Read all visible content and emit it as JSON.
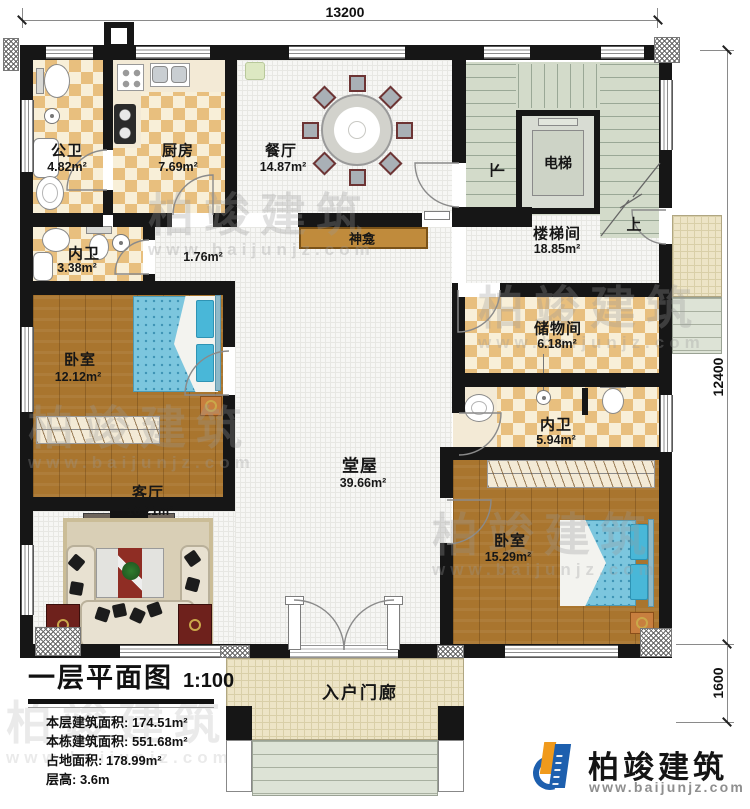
{
  "plan": {
    "dim_top": "13200",
    "dim_right": "12400",
    "dim_porch": "1600",
    "stair_down": "下",
    "stair_up": "上"
  },
  "rooms": {
    "public_bath": {
      "name": "公卫",
      "area": "4.82m²"
    },
    "kitchen": {
      "name": "厨房",
      "area": "7.69m²"
    },
    "dining": {
      "name": "餐厅",
      "area": "14.87m²"
    },
    "elevator": {
      "name": "电梯"
    },
    "stair_hall": {
      "name": "楼梯间",
      "area": "18.85m²"
    },
    "inner_bath_1": {
      "name": "内卫",
      "area": "3.38m²"
    },
    "shrine": {
      "name": "神龛",
      "area": "1.76m²"
    },
    "bedroom_1": {
      "name": "卧室",
      "area": "12.12m²"
    },
    "storage": {
      "name": "储物间",
      "area": "6.18m²"
    },
    "inner_bath_2": {
      "name": "内卫",
      "area": "5.94m²"
    },
    "main_hall": {
      "name": "堂屋",
      "area": "39.66m²"
    },
    "living_room": {
      "name": "客厅",
      "area": "16.21m²"
    },
    "bedroom_2": {
      "name": "卧室",
      "area": "15.29m²"
    },
    "entry_porch": {
      "name": "入户门廊"
    }
  },
  "legend": {
    "title": "一层平面图",
    "scale": "1:100",
    "stats": [
      {
        "label": "本层建筑面积:",
        "value": "174.51m²"
      },
      {
        "label": "本栋建筑面积:",
        "value": "551.68m²"
      },
      {
        "label": "占地面积:",
        "value": "178.99m²"
      },
      {
        "label": "层高:",
        "value": "3.6m"
      }
    ]
  },
  "brand": {
    "name": "柏竣建筑",
    "url": "www.baijunjz.com"
  },
  "watermark": {
    "name": "柏竣建筑",
    "url": "www.baijunjz.com"
  },
  "colors": {
    "wall": "#161616",
    "tile": "#e8bf7e",
    "wood": "#a9752e",
    "brand_blue": "#1d5fae",
    "brand_orange": "#f09a1c"
  }
}
